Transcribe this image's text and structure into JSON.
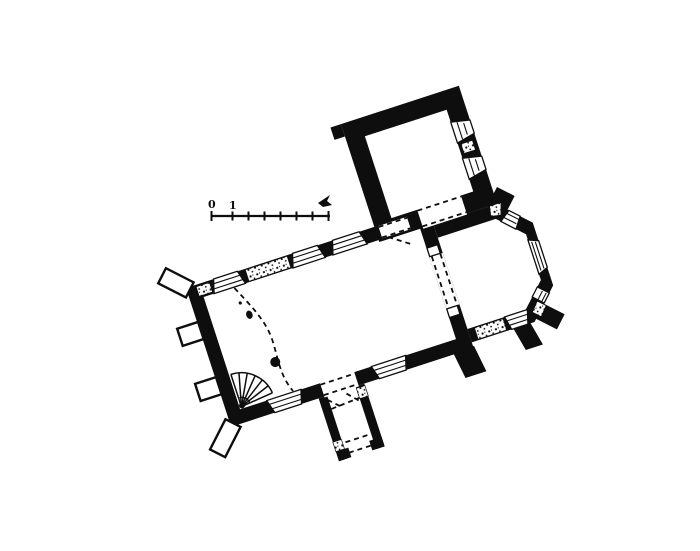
{
  "figure": {
    "kind": "church-floor-plan",
    "rooms": [
      "nave",
      "chancel",
      "polygonal-apse",
      "tower",
      "south-porch"
    ],
    "features": [
      "spiral-staircase",
      "diagonal-corner-buttresses",
      "splayed-windows",
      "stippled-masonry-patches",
      "dashed-former-wall-line"
    ]
  },
  "scale_bar": {
    "start_label": "0",
    "first_tick_label": "1",
    "tick_count": 8,
    "end_icon": "flag-mark"
  },
  "colors": {
    "ink": "#0e0e0e",
    "paper": "#ffffff"
  }
}
